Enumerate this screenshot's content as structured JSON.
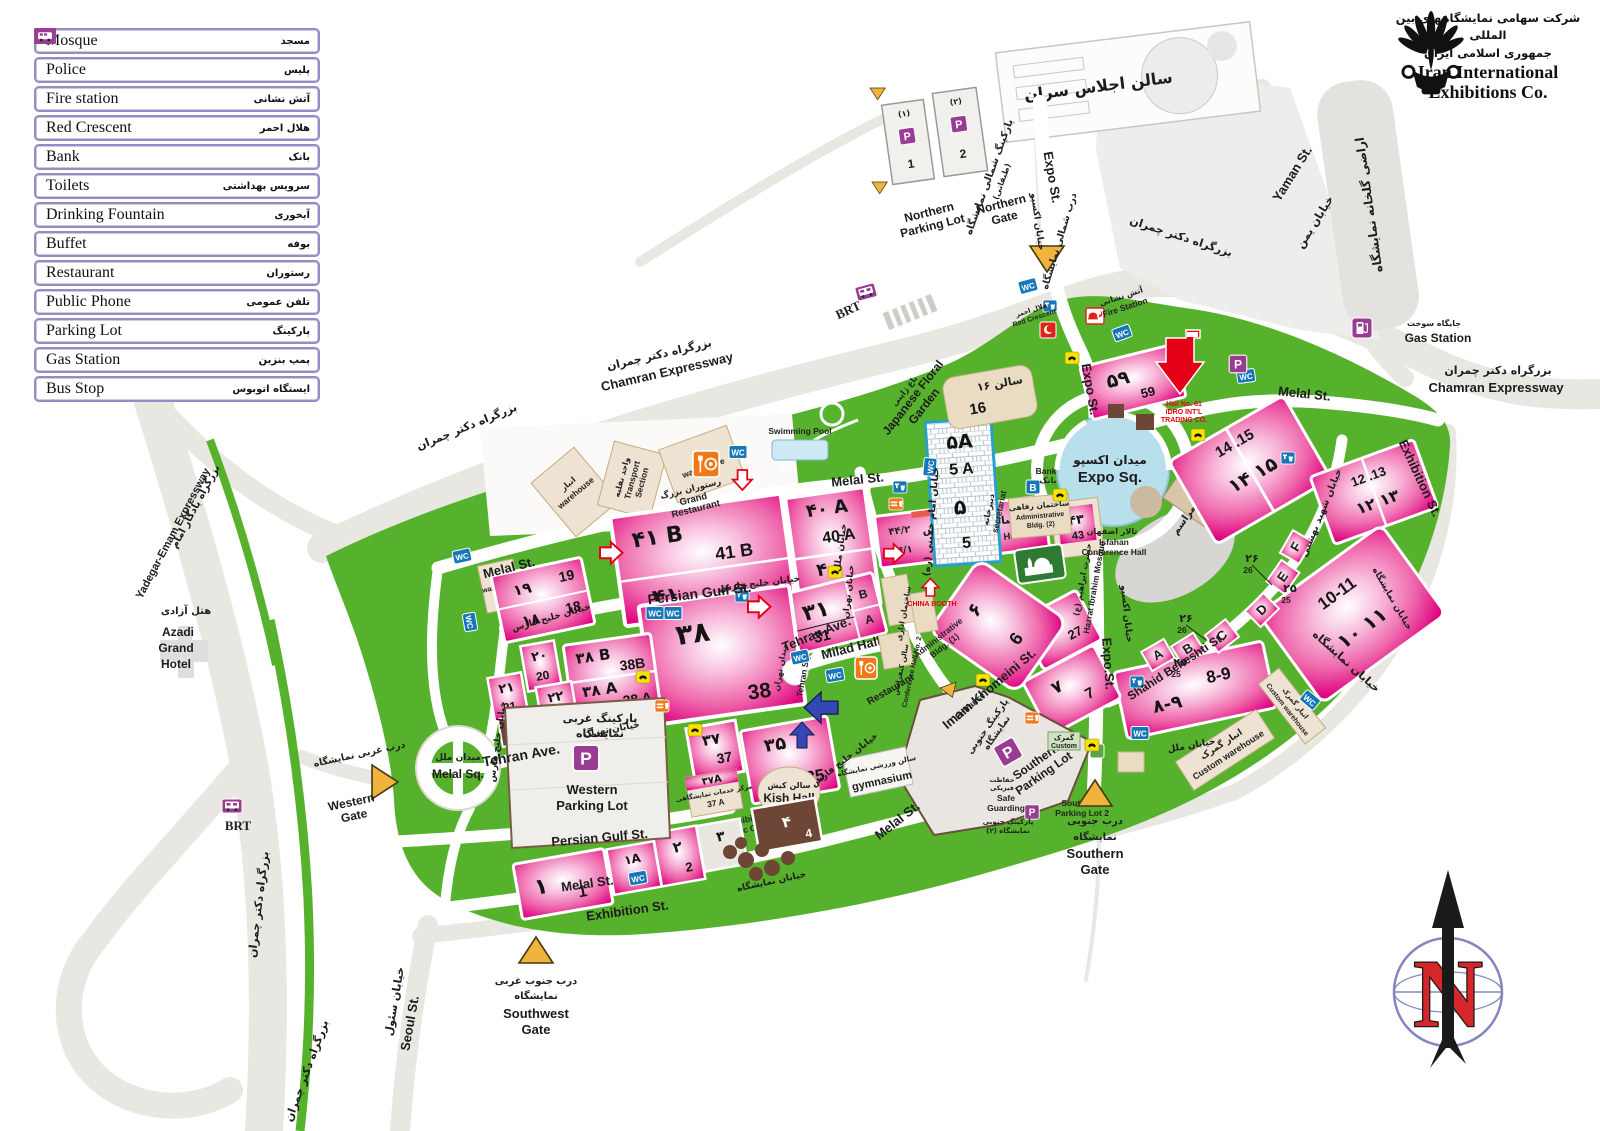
{
  "legend": {
    "items": [
      {
        "en": "Mosque",
        "fa": "مسجد",
        "icon": "mosque"
      },
      {
        "en": "Police",
        "fa": "پلیس",
        "icon": "police"
      },
      {
        "en": "Fire station",
        "fa": "آتش نشانی",
        "icon": "fire"
      },
      {
        "en": "Red Crescent",
        "fa": "هلال احمر",
        "icon": "crescent"
      },
      {
        "en": "Bank",
        "fa": "بانک",
        "icon": "bank"
      },
      {
        "en": "Toilets",
        "fa": "سرویس بهداشتی",
        "icon": "wc"
      },
      {
        "en": "Drinking Fountain",
        "fa": "آبخوری",
        "icon": "fountain"
      },
      {
        "en": "Buffet",
        "fa": "بوفه",
        "icon": "buffet"
      },
      {
        "en": "Restaurant",
        "fa": "رستوران",
        "icon": "restaurant"
      },
      {
        "en": "Public Phone",
        "fa": "تلفن عمومی",
        "icon": "phone"
      },
      {
        "en": "Parking Lot",
        "fa": "پارکینگ",
        "icon": "parking"
      },
      {
        "en": "Gas Station",
        "fa": "پمپ بنزین",
        "icon": "gas"
      },
      {
        "en": "Bus Stop",
        "fa": "ایستگاه اتوبوس",
        "icon": "bus"
      }
    ]
  },
  "logo": {
    "fa_line1": "شرکت سهامی نمایشگاههای بین المللی",
    "fa_line2": "جمهوری اسلامی ایران",
    "en_line1": "Iran International",
    "en_line2": "Exhibitions Co."
  },
  "compass": {
    "n": "N"
  },
  "colors": {
    "green": "#56b22d",
    "hall_pink": "#e0007f",
    "road_grey": "#e9e7e2",
    "icon_blue": "#1677b8",
    "icon_purple": "#993d94",
    "icon_orange": "#f07818",
    "icon_yellow": "#f8e300",
    "icon_red": "#e32119"
  },
  "map": {
    "icons": {
      "wc": "WC",
      "p": "P",
      "b": "B",
      "brt": "BRT"
    },
    "streets": {
      "chamran_en": "Chamran Expressway",
      "chamran_fa": "بزرگراه دکتر چمران",
      "yadegar_en": "Yadegar-Emam Expressway",
      "yadegar_fa": "بزرگراه یادگار امام",
      "seoul_en": "Seoul St.",
      "seoul_fa": "خیابان سئول",
      "yaman_en": "Yaman St.",
      "yaman_fa": "خیابان یمن",
      "exhibition_en": "Exhibition St.",
      "exhibition_fa": "خیابان نمایشگاه",
      "melal_en": "Melal St.",
      "melal_fa": "خیابان ملل",
      "expo_en": "Expo St.",
      "expo_dot_en": "Expo.St.",
      "expo_fa": "خیابان اکسپو",
      "pgulf_en": "Persian Gulf  St.",
      "pgulf_fa": "خیابان خلیج فارس",
      "tehran_en": "Tehran Ave.",
      "tehran_fa": "خیابان تهران",
      "imam_en": "Imam Khomeini St.",
      "imam_fa": "خیابان امام خمینی (ره)",
      "beheshti_en": "Shahid Beheshti St.",
      "beheshti_fa": "خیابان شهید بهشتی"
    },
    "squares": {
      "melal_en": "Melal Sq.",
      "melal_fa": "میدان ملل",
      "expo_en": "Expo Sq.",
      "expo_fa": "میدان اکسپو",
      "tehran_en": "Tehran Sq.",
      "tehran_fa": "میدان تهران"
    },
    "gates": {
      "north_en1": "Northern",
      "north_en2": "Gate",
      "north_fa": "درب شمالی نمایشگاه",
      "west_en1": "Western",
      "west_en2": "Gate",
      "west_fa": "درب غربی نمایشگاه",
      "south_en1": "Southern",
      "south_en2": "Gate",
      "south_fa1": "درب جنوبی",
      "south_fa2": "نمایشگاه",
      "sw_en1": "Southwest",
      "sw_en2": "Gate",
      "sw_fa1": "درب جنوب غربی",
      "sw_fa2": "نمایشگاه"
    },
    "parking": {
      "north_en1": "Northern",
      "north_en2": "Parking Lot",
      "north_fa1": "پارکینگ شمالی نمایشگاه",
      "north_fa2": "(طبقاتی)",
      "p1_fa": "(۱)",
      "p1": "1",
      "p2_fa": "(۲)",
      "p2": "2",
      "west_fa1": "پارکینگ غربی",
      "west_fa2": "نمایشگاه",
      "west_en1": "Western",
      "west_en2": "Parking Lot",
      "south_fa1": "پارکینگ جنوبی",
      "south_fa2": "نمایشگاه",
      "south_en1": "Southern",
      "south_en2": "Parking Lot",
      "entrance": "Entrance",
      "sp2_en1": "Southern",
      "sp2_en2": "Parking Lot 2",
      "sp2_fa1": "پارکینگ جنوبی",
      "sp2_fa2": "نمایشگاه (۲)"
    },
    "places": {
      "summit_fa": "سالن اجلاس سران",
      "azadi_fa": "هتل آزادی",
      "azadi_en1": "Azadi",
      "azadi_en2": "Grand",
      "azadi_en3": "Hotel",
      "gas_fa": "جایگاه سوخت",
      "gas_en": "Gas Station",
      "greenhouse_fa": "اراضی گلخانه نمایشگاه",
      "fire_fa": "آتش نشانی",
      "fire_en": "Fire Station",
      "crescent_fa": "هلال احمر",
      "crescent_en": "Red Crescent",
      "garden_en1": "Japanese Floral",
      "garden_en2": "Garden",
      "garden_fa": "باغ ژاپنی",
      "pool_en": "Swimming Pool",
      "grest_fa": "رستوران بزرگ",
      "grest_en1": "Grand",
      "grest_en2": "Restaurant",
      "wh_en": "warehouse",
      "wh_fa": "انبار",
      "transport_fa": "واحد نقلیه",
      "transport_en1": "Transport",
      "transport_en2": "Section",
      "secretariat_en": "secretariat",
      "secretariat_fa": "دبیرخانه",
      "admin2_fa": "ساختمان رفاهی",
      "admin2_en1": "Administrative",
      "admin2_en2": "Bldg. (2)",
      "isfahan_fa": "تالار اصفهان",
      "isfahan_en1": "Isfahan",
      "isfahan_en2": "Conference Hall",
      "bank_en": "Bank",
      "bank_fa": "بانک",
      "mosque_fa": "حضرت ابراهیم (ع)",
      "mosque_en": "Hazrat Ibrahim Mosque",
      "ceremonies_fa": "جایگاه مراسم",
      "admin1_fa": "ساختمان اداری",
      "admin1_en1": "Administrative",
      "admin1_en2": "Bldg. (1)",
      "conf2_fa": "سالن کنفرانس",
      "conf2_en": "Conference Hall No. 2",
      "restaurant_en": "Restaurant",
      "gym_fa": "سالن ورزشی نمایشگاه",
      "gym_en": "gymnasium",
      "custom_fa": "گمرک",
      "custom_en": "Custom",
      "safe_fa1": "حفاظت",
      "safe_fa2": "فیزیکی",
      "safe_en1": "Safe",
      "safe_en2": "Guarding",
      "cwh_fa": "انبار گمرک",
      "cwh_en": "Custom warehouse",
      "kish_fa": "سالن کیش",
      "kish_en": "Kish Hall",
      "esc_fa": "مرکز خدمات نمایشگاهی",
      "esc_en1": "Exhibition",
      "esc_en2": "Servic Center",
      "china": "CHINA BOOTH",
      "idro1": "Hall No. 61",
      "idro2": "IDRO INT'L",
      "idro3": "TRADING CO.",
      "brt": "BRT"
    },
    "halls": {
      "h41b_fa": "۴۱ B",
      "h41b_en": "41 B",
      "h41_fa": "۴۱",
      "h41_en": "41",
      "h40a_fa": "۴۰ A",
      "h40a_en": "40 A",
      "h40_fa": "۴۰",
      "h40_en": "40",
      "h44_name_fa": "سالن خلیج فارس",
      "h44_en": "Persian Gulf Hall",
      "h441_en": "44/1",
      "h442_en": "44/2",
      "h441_fa": "۴۴/۱",
      "h442_fa": "۴۴/۲",
      "h43_fa": "۴۳",
      "h43_en": "43",
      "h31_fa": "۳۱",
      "h31_en": "31",
      "h31_b": "B",
      "h31_a": "A",
      "milad_en": "Milad Hall",
      "h38_fa": "۳۸",
      "h38_en": "38",
      "h38b_fa": "۳۸ B",
      "h38b_en": "38B",
      "h38a_fa": "۳۸ A",
      "h38a_en": "38 A",
      "h19_fa": "۱۹",
      "h19_en": "19",
      "h18_fa": "۱۸",
      "h18_en": "18",
      "h20_fa": "۲۰",
      "h20_en": "20",
      "h21_fa": "۲۱",
      "h21_en": "21",
      "h22_fa": "۲۲",
      "h22_en": "22",
      "h23_fa": "۲۳",
      "h37_fa": "۳۷",
      "h37_en": "37",
      "h35_fa": "۳۵",
      "h35_en": "35",
      "h37a_fa": "۳۷A",
      "h37a_en": "37 A",
      "h1_fa": "۱",
      "h1_en": "1",
      "h1a_fa": "۱A",
      "h1a_en": "1A",
      "h2_fa": "۲",
      "h2_en": "2",
      "h3_fa": "۳",
      "h3_en": "3",
      "h4_fa": "۴",
      "h4_en": "4",
      "h5_fa": "۵",
      "h5_en": "5",
      "h5a_fa": "۵A",
      "h5a_en": "5 A",
      "h16_fa": "سالن ۱۶",
      "h16_en": "16",
      "h59_fa": "۵۹",
      "h59_en": "59",
      "h6_fa": "۶",
      "h6_en": "6",
      "h27_fa": "۲۷",
      "h27_en": "27",
      "h7_fa": "۷",
      "h7_en": "7",
      "h89_fa": "۸-۹",
      "h89_en": "8-9",
      "h1011_fa": "۱۰ ۱۱",
      "h1011_en": "10-11",
      "h1213_fa": "۱۲ ۱۳",
      "h1213_en": "12 .13",
      "h1415_fa": "۱۴ ۱۵",
      "h1415_en": "14 .15",
      "ha": "A",
      "hb": "B",
      "hc": "C",
      "hd": "D",
      "he": "E",
      "hf": "F",
      "n26_fa": "۲۶",
      "n26_en": "26",
      "n25_fa": "۲۵",
      "n25_en": "25"
    }
  }
}
